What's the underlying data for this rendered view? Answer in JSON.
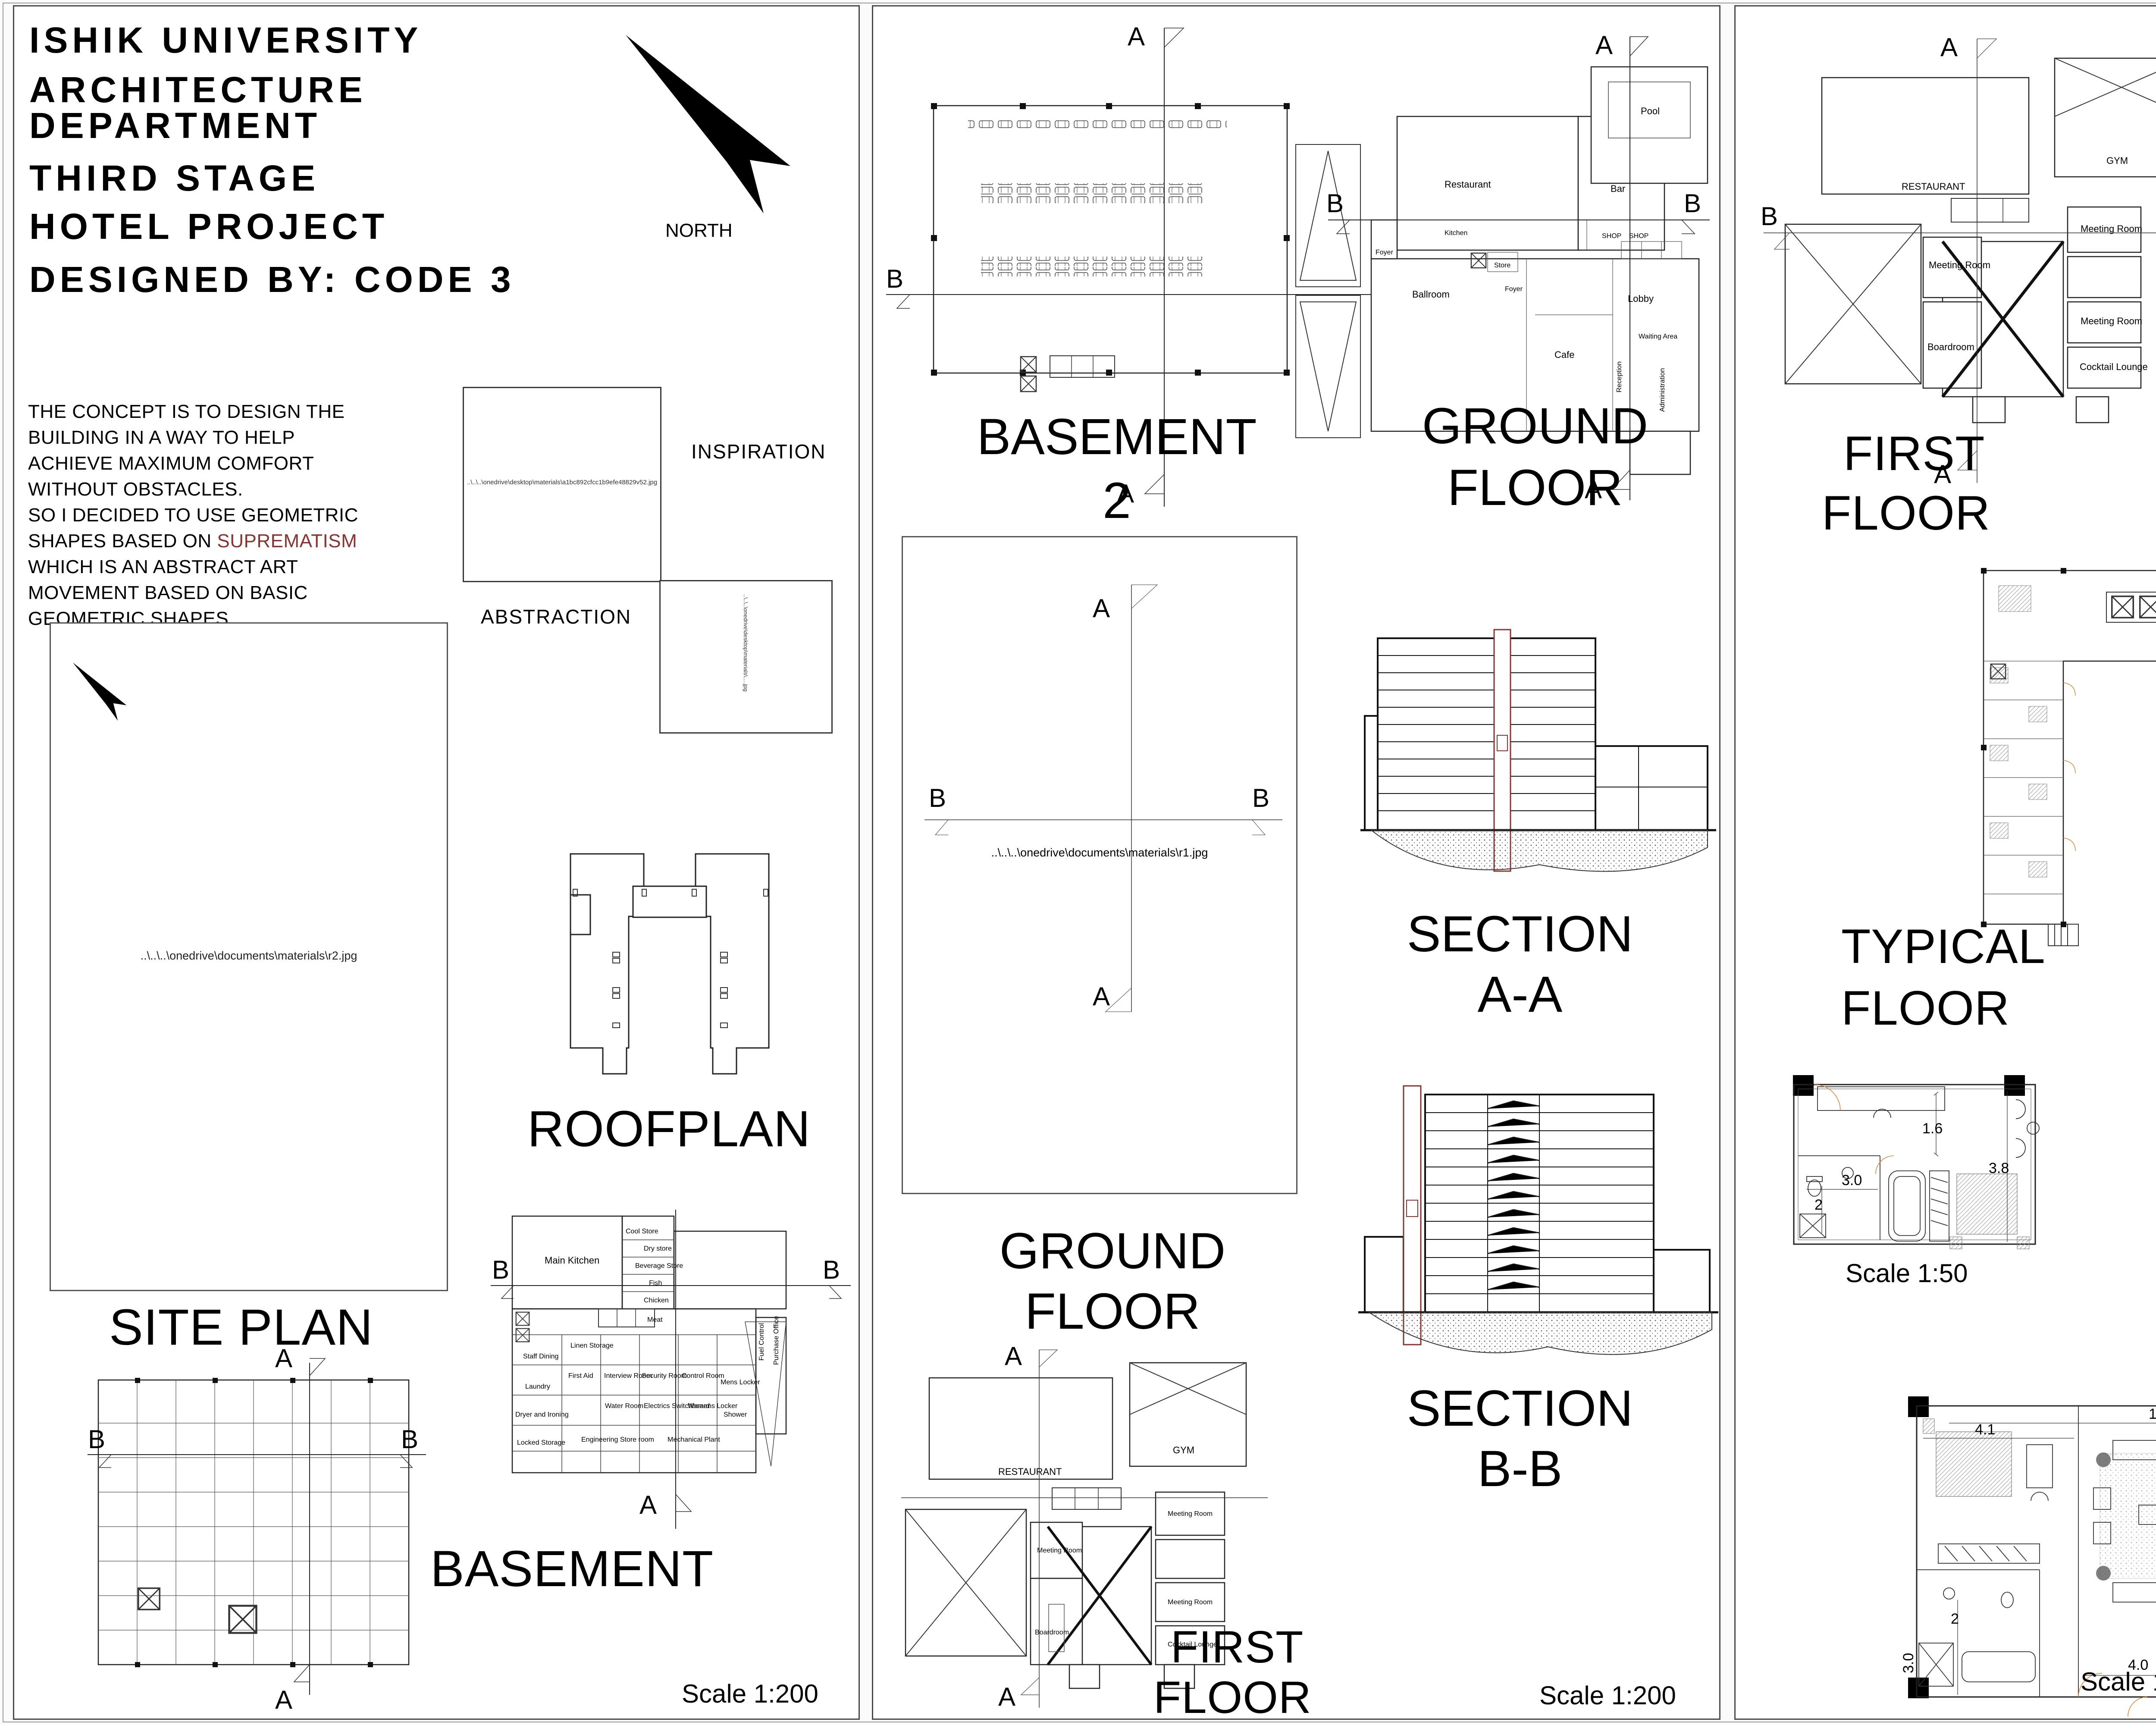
{
  "colors": {
    "accent_cyan": "#6FE0EA",
    "glass_dark": "#1F2B3A",
    "suprematism_red": "#8A3431",
    "lawn_green": "#567C3F",
    "sky_blue": "#4E86C8",
    "tan_sky": "#D9D4C6"
  },
  "titleblock": {
    "lines": [
      "ISHIK UNIVERSITY",
      "ARCHITECTURE",
      "DEPARTMENT",
      "THIRD STAGE",
      "HOTEL PROJECT",
      "DESIGNED BY: CODE 3"
    ],
    "north_label": "NORTH"
  },
  "concept": {
    "text_start": "THE CONCEPT IS TO DESIGN THE\nBUILDING IN A WAY TO HELP\nACHIEVE MAXIMUM COMFORT\nWITHOUT OBSTACLES.\nSO I DECIDED TO USE GEOMETRIC\nSHAPES BASED ON ",
    "highlight": "SUPREMATISM",
    "text_end": "\nWHICH IS AN ABSTRACT ART\nMOVEMENT BASED ON BASIC\nGEOMETRIC SHAPES,"
  },
  "markers": {
    "a": "A",
    "b": "B"
  },
  "panel1": {
    "inspiration_label": "INSPIRATION",
    "inspiration_path": "..\\..\\..\\onedrive\\desktop\\materials\\a1bc892cfcc1b9efe48829v52.jpg",
    "abstraction_label": "ABSTRACTION",
    "abstraction_path": "..\\..\\..\\onedrive\\desktop\\materials\\….jpg",
    "site_plan_label": "SITE PLAN",
    "site_plan_path": "..\\..\\..\\onedrive\\documents\\materials\\r2.jpg",
    "roofplan_label": "ROOFPLAN",
    "basement_label": "BASEMENT",
    "scale_label": "Scale 1:200",
    "basement_rooms": {
      "main_kitchen": "Main Kitchen",
      "cool_store": "Cool Store",
      "dry_store": "Dry store",
      "beverage_store": "Beverage Store",
      "fish": "Fish",
      "chicken": "Chicken",
      "meat": "Meat",
      "staff_dining": "Staff Dining",
      "laundry": "Laundry",
      "dryer": "Dryer and Ironing",
      "locked_storage": "Locked Storage",
      "linen_storage": "Linen Storage",
      "first_aid": "First Aid",
      "interview": "Interview Room",
      "security": "Security Room",
      "control": "Control Room",
      "water": "Water Room",
      "electrics": "Electrics Switchboard",
      "womens_locker": "Womens Locker",
      "mens_locker": "Mens Locker",
      "shower": "Shower",
      "eng_store": "Engineering Store room",
      "mech_plant": "Mechanical Plant",
      "fuel": "Fuel Control",
      "purchase": "Purchase Office"
    }
  },
  "panel2": {
    "basement2_label": "BASEMENT",
    "basement2_number": "2",
    "ground_label1": "GROUND",
    "ground_label2": "FLOOR",
    "ground_rooms": {
      "restaurant": "Restaurant",
      "bar": "Bar",
      "pool": "Pool",
      "kitchen": "Kitchen",
      "ballroom": "Ballroom",
      "foyer": "Foyer",
      "foyer2": "Foyer",
      "cafe": "Cafe",
      "lobby": "Lobby",
      "waiting": "Waiting Area",
      "reception": "Reception",
      "administration": "Administration",
      "shop1": "SHOP",
      "shop2": "SHOP",
      "store": "Store"
    },
    "placeholder_path": "..\\..\\..\\onedrive\\documents\\materials\\r1.jpg",
    "mid_label1": "GROUND",
    "mid_label2": "FLOOR",
    "section_a_line1": "SECTION",
    "section_a_line2": "A-A",
    "section_b_line1": "SECTION",
    "section_b_line2": "B-B",
    "first_label1": "FIRST",
    "first_label2": "FLOOR",
    "scale_label": "Scale 1:200"
  },
  "first_floor_rooms": {
    "restaurant": "RESTAURANT",
    "gym": "GYM",
    "meeting1": "Meeting Room",
    "meeting2": "Meeting Room",
    "meeting3": "Meeting Room",
    "boardroom": "Boardroom",
    "cocktail": "Cocktail Lounge"
  },
  "panel3": {
    "first_label1": "FIRST",
    "first_label2": "FLOOR",
    "service_label1": "SERVICE",
    "service_label2": "FLOOR",
    "typical_label1": "TYPICAL",
    "typical_label2": "FLOOR",
    "typical_rooms": {
      "linen": "Linen Storage",
      "storage": "Storage"
    },
    "detail_small": {
      "dims": {
        "d16": "1.6",
        "d30": "3.0",
        "d2": "2",
        "d38": "3.8"
      },
      "scale": "Scale 1:50"
    },
    "detail_suite": {
      "dims": {
        "d30": "3.0",
        "d2": "2",
        "d72r": "7.2",
        "d72b": "7.2"
      },
      "scale": "Scale 1:50"
    },
    "detail_double": {
      "dims": {
        "d142": "14.2",
        "d41": "4.1",
        "d58": "5.8",
        "d72": "7.2",
        "d40": "4.0",
        "d2l": "2",
        "d30l": "3.0",
        "d2r": "2",
        "d30r": "3.0"
      },
      "scale": "Scale 1:50"
    }
  },
  "panel4": {
    "title": "3D VIEWS",
    "render_names": [
      "aerial site view",
      "street corner view",
      "aerial pool view",
      "front courtyard view",
      "glass tower street view"
    ]
  }
}
